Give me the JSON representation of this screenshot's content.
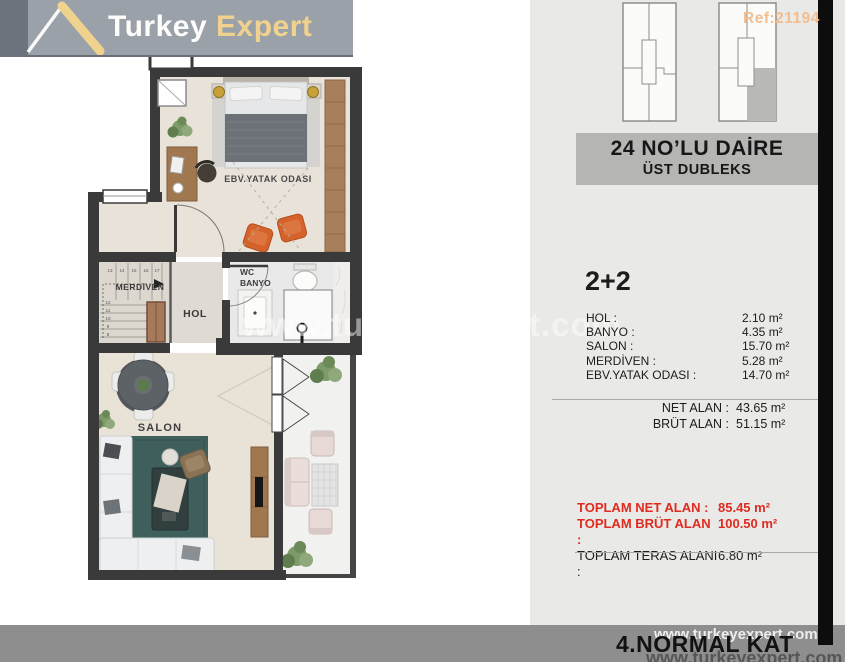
{
  "logo": {
    "brand_primary": "Turkey",
    "brand_secondary": "Expert"
  },
  "ref_label": "Ref:21194",
  "title_line1": "24 NO’LU DAİRE",
  "title_line2": "ÜST DUBLEKS",
  "unit_type": "2+2",
  "room_rows": [
    {
      "label": "HOL :",
      "value": "2.10 m²"
    },
    {
      "label": "BANYO :",
      "value": "4.35 m²"
    },
    {
      "label": "SALON :",
      "value": "15.70 m²"
    },
    {
      "label": "MERDİVEN :",
      "value": "5.28 m²"
    },
    {
      "label": "EBV.YATAK ODASI :",
      "value": "14.70 m²"
    }
  ],
  "net_rows": [
    {
      "label": "NET ALAN :",
      "value": "43.65 m²"
    },
    {
      "label": "BRÜT ALAN :",
      "value": "51.15 m²"
    }
  ],
  "total_rows": [
    {
      "label": "TOPLAM NET ALAN :",
      "value": "85.45 m²"
    },
    {
      "label": "TOPLAM BRÜT ALAN :",
      "value": "100.50 m²"
    },
    {
      "label": "TOPLAM TERAS ALANI :",
      "value": "6.80 m²"
    }
  ],
  "floor_label": "4.NORMAL KAT",
  "watermark": "www.turkeyexpert.com",
  "plan_labels": {
    "bedroom": "EBV.YATAK ODASI",
    "stairs": "MERDİVEN",
    "hall": "HOL",
    "wc_line1": "WC",
    "wc_line2": "BANYO",
    "salon": "SALON"
  },
  "step_numbers": [
    "8",
    "9",
    "10",
    "11",
    "12",
    "13",
    "14",
    "15",
    "16",
    "17"
  ],
  "colors": {
    "accent_red": "#e02b20",
    "panel_bg": "#e9e9e7",
    "band_bg": "#8e8e8e",
    "logo_band": "#9ba1a9",
    "wall": "#3a3a3a",
    "gold": "#f0d28e"
  }
}
